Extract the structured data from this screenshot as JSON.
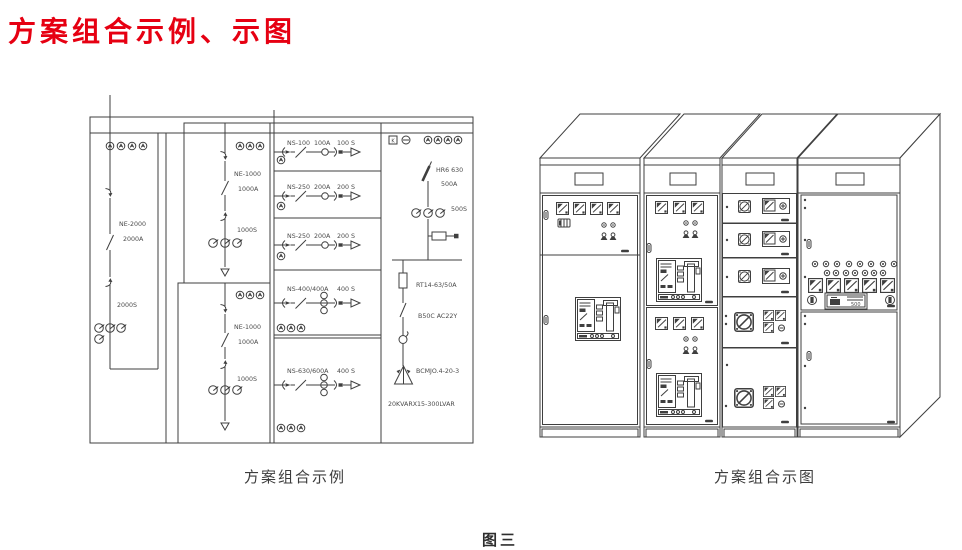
{
  "page": {
    "title": "方案组合示例、示图",
    "figure_label": "图三",
    "title_color": "#e60012",
    "background": "#ffffff"
  },
  "schematic": {
    "caption": "方案组合示例",
    "incomer": {
      "model": "NE-2000",
      "current": "2000A",
      "ct": "2000S"
    },
    "feeders_ne": [
      {
        "model": "NE-1000",
        "current": "1000A",
        "ct": "1000S"
      },
      {
        "model": "NE-1000",
        "current": "1000A",
        "ct": "1000S"
      }
    ],
    "feeders_ns": [
      {
        "model": "NS-100",
        "current": "100A",
        "ct": "100 S"
      },
      {
        "model": "NS-250",
        "current": "200A",
        "ct": "200 S"
      },
      {
        "model": "NS-250",
        "current": "200A",
        "ct": "200 S"
      },
      {
        "model": "NS-400/400A",
        "ct": "400 S"
      },
      {
        "model": "NS-630/600A",
        "ct": "400 S"
      }
    ],
    "capacitor_branch": {
      "k_label": "K",
      "switch_model": "HR6 630",
      "switch_current": "500A",
      "ct": "500S",
      "fuse": "RT14-63/50A",
      "contactor": "B50C AC22Y",
      "capacitor_model": "BCMJO.4-20-3",
      "bank_rating": "20KVARX15-300LVAR"
    }
  },
  "cabinet_view": {
    "caption": "方案组合示图",
    "meter_display": "500"
  }
}
